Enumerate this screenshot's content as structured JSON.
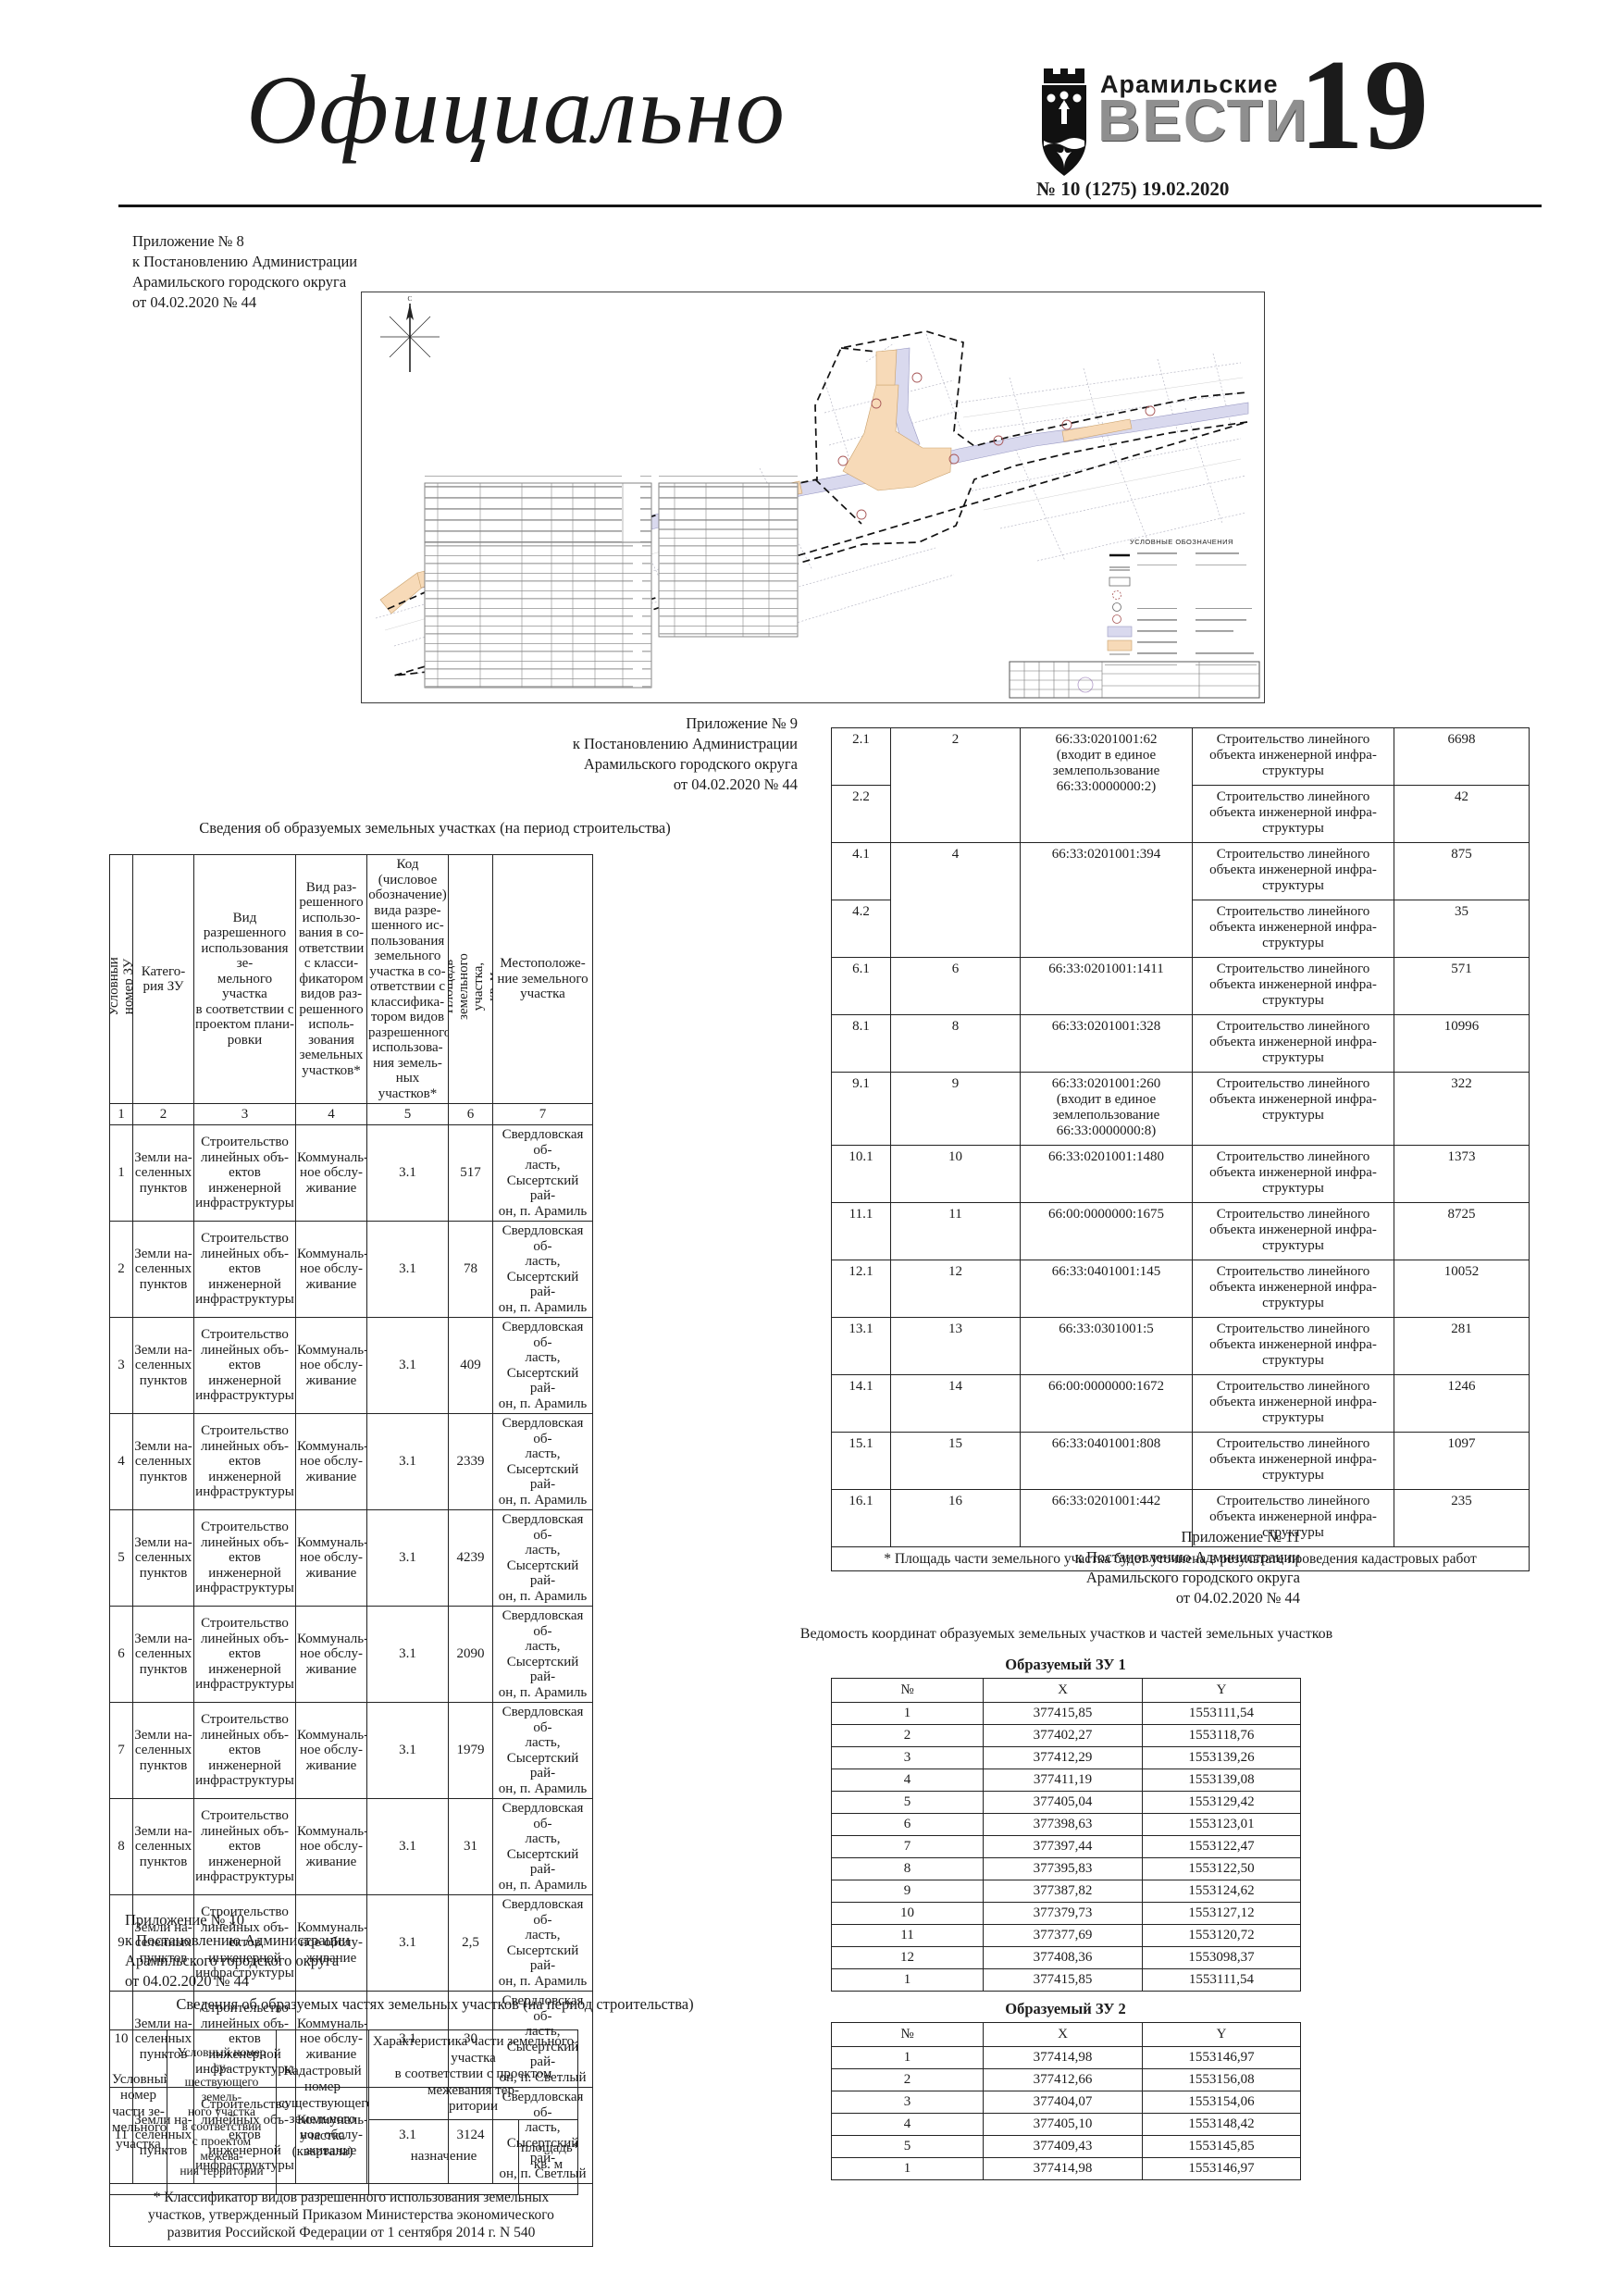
{
  "header": {
    "section_title": "Официально",
    "brand_line1": "Арамильские",
    "brand_line2": "ВЕСТИ",
    "issue": "№ 10 (1275) 19.02.2020",
    "page_number": "19"
  },
  "map": {
    "legend_title": "УСЛОВНЫЕ ОБОЗНАЧЕНИЯ",
    "compass_label": "С"
  },
  "appendix8": {
    "lines": "Приложение № 8\nк Постановлению Администрации\nАрамильского городского округа\nот 04.02.2020 № 44"
  },
  "appendix9": {
    "lines": "Приложение № 9\nк Постановлению Администрации\nАрамильского городского округа\nот 04.02.2020 № 44",
    "table_title": "Сведения об образуемых земельных участках (на период строительства)",
    "table": {
      "col_headers": [
        "Условный номер ЗУ",
        "Катего-\nрия ЗУ",
        "Вид разрешенного\nиспользования зе-\nмельного участка\nв соответствии с\nпроектом плани-\nровки",
        "Вид раз-\nрешенного\nиспользо-\nвания в со-\nответствии\nс класси-\nфикатором\nвидов раз-\nрешенного\nисполь-\nзования\nземельных\nучастков*",
        "Код (числовое\nобозначение)\nвида разре-\nшенного ис-\nпользования\nземельного\nучастка в со-\nответствии с\nклассифика-\nтором видов\nразрешенного\nиспользова-\nния земель-\nных участков*",
        "Площадь земельного участка,\nкв. м",
        "Местоположе-\nние земельного\nучастка"
      ],
      "number_row": [
        "1",
        "2",
        "3",
        "4",
        "5",
        "6",
        "7"
      ],
      "category": "Земли на-\nселенных\nпунктов",
      "permitted_use": "Строительство\nлинейных объ-\nектов инженерной\nинфраструктуры",
      "classifier_use": "Коммуналь-\nное обслу-\nживание",
      "code": "3.1",
      "location_aramil": "Свердловская об-\nласть,\nСысертский рай-\nон, п. Арамиль",
      "location_svetly": "Свердловская об-\nласть,\nСысертский рай-\nон, п. Светлый",
      "rows": [
        {
          "num": "1",
          "area": "517",
          "loc": "aramil"
        },
        {
          "num": "2",
          "area": "78",
          "loc": "aramil"
        },
        {
          "num": "3",
          "area": "409",
          "loc": "aramil"
        },
        {
          "num": "4",
          "area": "2339",
          "loc": "aramil"
        },
        {
          "num": "5",
          "area": "4239",
          "loc": "aramil"
        },
        {
          "num": "6",
          "area": "2090",
          "loc": "aramil"
        },
        {
          "num": "7",
          "area": "1979",
          "loc": "aramil"
        },
        {
          "num": "8",
          "area": "31",
          "loc": "aramil"
        },
        {
          "num": "9",
          "area": "2,5",
          "loc": "aramil"
        },
        {
          "num": "10",
          "area": "30",
          "loc": "svetly"
        },
        {
          "num": "11",
          "area": "3124",
          "loc": "svetly"
        }
      ],
      "footnote": "* Классификатор видов разрешенного использования земельных участков, утвержденный Приказом Министерства экономического развития Российской Федерации от 1 сентября 2014 г. N 540"
    }
  },
  "continuation_table": {
    "purpose": "Строительство линейного\nобъекта инженерной инфра-\nструктуры",
    "rows": [
      {
        "id": "2.1",
        "zu": "2",
        "zu_span": 2,
        "cad": "66:33:0201001:62\n(входит в единое\nземлепользование\n66:33:0000000:2)",
        "cad_span": 2,
        "area": "6698"
      },
      {
        "id": "2.2",
        "area": "42"
      },
      {
        "id": "4.1",
        "zu": "4",
        "zu_span": 2,
        "cad": "66:33:0201001:394",
        "cad_span": 2,
        "area": "875"
      },
      {
        "id": "4.2",
        "area": "35"
      },
      {
        "id": "6.1",
        "zu": "6",
        "cad": "66:33:0201001:1411",
        "area": "571"
      },
      {
        "id": "8.1",
        "zu": "8",
        "cad": "66:33:0201001:328",
        "area": "10996"
      },
      {
        "id": "9.1",
        "zu": "9",
        "cad": "66:33:0201001:260\n(входит в единое\nземлепользование\n66:33:0000000:8)",
        "area": "322"
      },
      {
        "id": "10.1",
        "zu": "10",
        "cad": "66:33:0201001:1480",
        "area": "1373"
      },
      {
        "id": "11.1",
        "zu": "11",
        "cad": "66:00:0000000:1675",
        "area": "8725"
      },
      {
        "id": "12.1",
        "zu": "12",
        "cad": "66:33:0401001:145",
        "area": "10052"
      },
      {
        "id": "13.1",
        "zu": "13",
        "cad": "66:33:0301001:5",
        "area": "281"
      },
      {
        "id": "14.1",
        "zu": "14",
        "cad": "66:00:0000000:1672",
        "area": "1246"
      },
      {
        "id": "15.1",
        "zu": "15",
        "cad": "66:33:0401001:808",
        "area": "1097"
      },
      {
        "id": "16.1",
        "zu": "16",
        "cad": "66:33:0201001:442",
        "area": "235"
      }
    ],
    "footnote": "* Площадь части земельного участка будет уточнена в результате проведения кадастровых работ"
  },
  "appendix10": {
    "lines": "Приложение № 10\nк Постановлению Администрации\nАрамильского городского округа\nот 04.02.2020 № 44",
    "table_title": "Сведения об образуемых частях земельных участков (на период строительства)",
    "parts_header": {
      "c1": "Условный\nномер\nчасти зе-\nмельного\nучастка",
      "c2": "Условный номер су-\nществующего земель-\nного участка\nв соответствии\nс проектом межева-\nния территории",
      "c3": "Кадастровый номер\nсуществующего\nземельного участка\n(квартала)",
      "c4": "Характеристика части земельного участка\nв соответствии с проектом межевания тер-\nритории",
      "c4a": "назначение",
      "c4b": "площадь*,\nкв. м"
    }
  },
  "appendix11": {
    "lines": "Приложение № 11\nк Постановлению Администрации\nАрамильского городского округа\nот 04.02.2020 № 44",
    "title": "Ведомость координат образуемых земельных участков и частей земельных участков",
    "zu1": {
      "heading": "Образуемый ЗУ 1",
      "headers": [
        "№",
        "X",
        "Y"
      ],
      "rows": [
        [
          "1",
          "377415,85",
          "1553111,54"
        ],
        [
          "2",
          "377402,27",
          "1553118,76"
        ],
        [
          "3",
          "377412,29",
          "1553139,26"
        ],
        [
          "4",
          "377411,19",
          "1553139,08"
        ],
        [
          "5",
          "377405,04",
          "1553129,42"
        ],
        [
          "6",
          "377398,63",
          "1553123,01"
        ],
        [
          "7",
          "377397,44",
          "1553122,47"
        ],
        [
          "8",
          "377395,83",
          "1553122,50"
        ],
        [
          "9",
          "377387,82",
          "1553124,62"
        ],
        [
          "10",
          "377379,73",
          "1553127,12"
        ],
        [
          "11",
          "377377,69",
          "1553120,72"
        ],
        [
          "12",
          "377408,36",
          "1553098,37"
        ],
        [
          "1",
          "377415,85",
          "1553111,54"
        ]
      ]
    },
    "zu2": {
      "heading": "Образуемый ЗУ 2",
      "headers": [
        "№",
        "X",
        "Y"
      ],
      "rows": [
        [
          "1",
          "377414,98",
          "1553146,97"
        ],
        [
          "2",
          "377412,66",
          "1553156,08"
        ],
        [
          "3",
          "377404,07",
          "1553154,06"
        ],
        [
          "4",
          "377405,10",
          "1553148,42"
        ],
        [
          "5",
          "377409,43",
          "1553145,85"
        ],
        [
          "1",
          "377414,98",
          "1553146,97"
        ]
      ]
    }
  }
}
